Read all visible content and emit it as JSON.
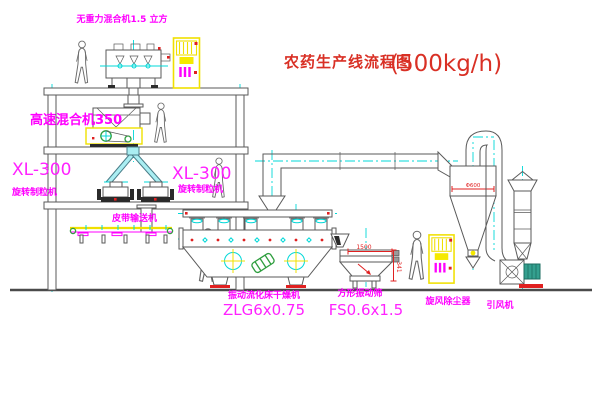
{
  "title": {
    "name_zh": "农药生产线流程图",
    "capacity": "(500kg/h)"
  },
  "equipment_labels": {
    "gravity_mixer": "无重力混合机1.5 立方",
    "high_speed_mixer": "高速混合机350",
    "granulator_left": {
      "model": "XL-300",
      "name": "旋转制粒机"
    },
    "granulator_right": {
      "model": "XL-300",
      "name": "旋转制粒机"
    },
    "belt_conveyor": "皮带输送机",
    "fluid_bed_dryer": {
      "name": "振动流化床干燥机",
      "model": "ZLG6x0.75"
    },
    "square_sieve": {
      "name": "方形振动筛",
      "model": "FS0.6x1.5"
    },
    "cyclone": "旋风除尘器",
    "induced_draft_fan": "引风机"
  },
  "dimensions": {
    "cyclone_diameter": "Φ600",
    "sieve_length": "1500",
    "sieve_height": "341"
  },
  "colors": {
    "label_magenta": "#ff00ff",
    "title_red": "#d93025",
    "line_gray": "#5a5a5a",
    "centerline_cyan": "#00d8d8",
    "cabinet_yellow": "#f0e000",
    "accent_red": "#e02020",
    "motor_green": "#2e9e3e",
    "motor_teal": "#34a08f",
    "pipe_cyan": "#aaeef2"
  }
}
